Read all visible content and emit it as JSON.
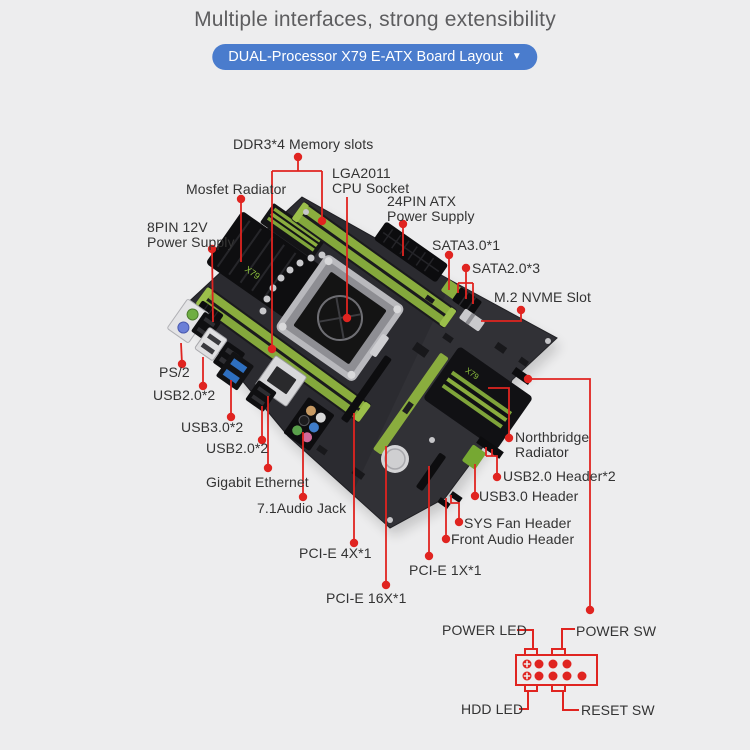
{
  "title": "Multiple interfaces, strong extensibility",
  "banner": {
    "label": "DUAL-Processor X79 E-ATX Board Layout",
    "dropdown_arrow": "▼"
  },
  "callouts": {
    "memory": "DDR3*4 Memory slots",
    "mosfet": "Mosfet Radiator",
    "cpu": "LGA2011\nCPU Socket",
    "atx24": "24PIN ATX\nPower Supply",
    "pin8": "8PIN 12V\nPower Supply",
    "sata3": "SATA3.0*1",
    "sata2": "SATA2.0*3",
    "m2": "M.2 NVME Slot",
    "ps2": "PS/2",
    "usb2_rear_top": "USB2.0*2",
    "usb3_rear": "USB3.0*2",
    "usb2_rear_bottom": "USB2.0*2",
    "ethernet": "Gigabit Ethernet",
    "audio": "7.1Audio Jack",
    "pcie4": "PCI-E 4X*1",
    "pcie1": "PCI-E 1X*1",
    "pcie16": "PCI-E 16X*1",
    "northbridge": "Northbridge\nRadiator",
    "usb2_header": "USB2.0 Header*2",
    "usb3_header": "USB3.0 Header",
    "sys_fan": "SYS Fan Header",
    "front_audio": "Front Audio Header"
  },
  "front_panel": {
    "power_led": "POWER LED",
    "power_sw": "POWER SW",
    "hdd_led": "HDD LED",
    "reset_sw": "RESET SW"
  },
  "board": {
    "logo_text": "X79"
  },
  "colors": {
    "accent_red": "#e02420",
    "banner_blue": "#4a7ccd",
    "board_green": "#8aad3e",
    "pcb_dark": "#2b2b30",
    "background": "#ededee"
  }
}
